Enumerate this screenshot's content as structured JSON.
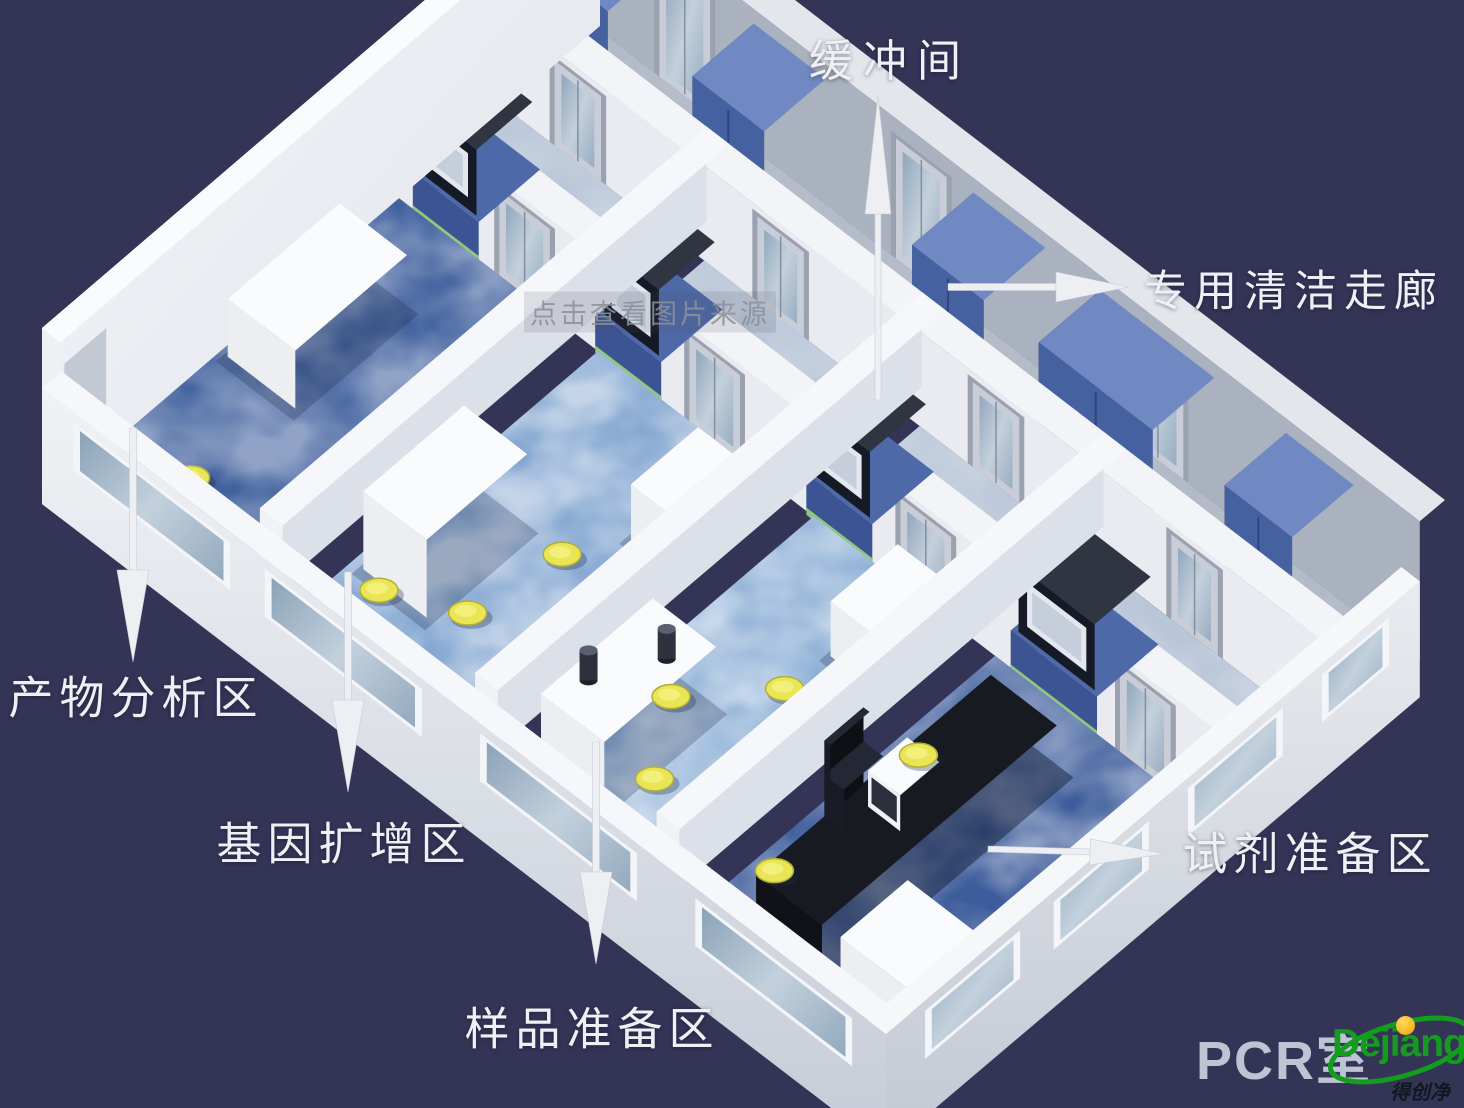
{
  "meta": {
    "width": 1464,
    "height": 1108,
    "background": "#343457",
    "title": "PCR实验室三维布局图"
  },
  "annotations": {
    "labels": [
      {
        "id": "buffer-room",
        "text": "缓冲间",
        "x": 890,
        "y": 60,
        "size": 44,
        "ls": 10
      },
      {
        "id": "clean-corridor",
        "text": "专用清洁走廊",
        "x": 1294,
        "y": 291,
        "size": 43,
        "ls": 7
      },
      {
        "id": "product-analysis-area",
        "text": "产物分析区",
        "x": 136,
        "y": 697,
        "size": 45,
        "ls": 6
      },
      {
        "id": "gene-amplification-area",
        "text": "基因扩增区",
        "x": 344,
        "y": 843,
        "size": 45,
        "ls": 6
      },
      {
        "id": "sample-preparation-area",
        "text": "样品准备区",
        "x": 592,
        "y": 1028,
        "size": 45,
        "ls": 6
      },
      {
        "id": "reagent-preparation-area",
        "text": "试剂准备区",
        "x": 1310,
        "y": 853,
        "size": 45,
        "ls": 6
      }
    ],
    "arrows": [
      {
        "id": "buffer-room",
        "x1": 878,
        "y1": 400,
        "x2": 878,
        "y2": 96,
        "shaft": 6,
        "headLen": 118,
        "headW": 26
      },
      {
        "id": "clean-corridor",
        "x1": 948,
        "y1": 287,
        "x2": 1128,
        "y2": 287,
        "shaft": 7,
        "headLen": 72,
        "headW": 30
      },
      {
        "id": "product-analysis",
        "x1": 133,
        "y1": 428,
        "x2": 133,
        "y2": 662,
        "shaft": 7,
        "headLen": 92,
        "headW": 32
      },
      {
        "id": "gene-amplification",
        "x1": 348,
        "y1": 572,
        "x2": 348,
        "y2": 792,
        "shaft": 7,
        "headLen": 92,
        "headW": 32
      },
      {
        "id": "sample-preparation",
        "x1": 596,
        "y1": 742,
        "x2": 596,
        "y2": 964,
        "shaft": 7,
        "headLen": 92,
        "headW": 32
      },
      {
        "id": "reagent-preparation",
        "x1": 988,
        "y1": 849,
        "x2": 1164,
        "y2": 854,
        "shaft": 6,
        "headLen": 74,
        "headW": 26
      }
    ],
    "watermark": {
      "text": "点击查看图片来源",
      "x": 650,
      "y": 312,
      "size": 27
    },
    "pcr_room": {
      "text": "PCR室",
      "x": 1196,
      "y": 1016,
      "size": 54
    },
    "logo": {
      "name": "Dejiang",
      "sub": "得创净化",
      "green": "#149c1e",
      "yellow": "#f0b400",
      "ink": "#12181f"
    }
  },
  "scene": {
    "corners": [
      [
        42,
        468
      ],
      [
        886,
        1114
      ],
      [
        1445,
        640
      ],
      [
        600,
        -10
      ]
    ],
    "colors": {
      "background": "#343457",
      "arrow": "#edeff3",
      "label": "#eef0f4",
      "wall_top": "#f5f6f9",
      "wall_front": "#eceef2",
      "wall_side": "#dce0e8",
      "cabinet_blue": "#46619f",
      "stool_yellow": "#e9e554",
      "glass": "#9db3c8",
      "floor_dark_blue": "#41619e",
      "floor_light_blue": "#7fa3cf",
      "corridor_floor": "#cdd5df",
      "buffer_floor": "#b9c6d8",
      "passbox_dark": "#151a26"
    },
    "rooms": [
      {
        "id": "product-analysis",
        "name": "产物分析区",
        "s": [
          0.022,
          0.235
        ],
        "floor": "#41619e",
        "mottle": 0.42
      },
      {
        "id": "gene-amplification",
        "name": "基因扩增区",
        "s": [
          0.262,
          0.49
        ],
        "floor": "#7fa3cf",
        "mottle": 0.55
      },
      {
        "id": "sample-preparation",
        "name": "样品准备区",
        "s": [
          0.517,
          0.705
        ],
        "floor": "#87abd4",
        "mottle": 0.55
      },
      {
        "id": "reagent-preparation",
        "name": "试剂准备区",
        "s": [
          0.732,
          0.978
        ],
        "floor": "#3d5c9b",
        "mottle": 0.42
      }
    ],
    "partitions": [
      [
        0.235,
        0.262
      ],
      [
        0.49,
        0.517
      ],
      [
        0.705,
        0.732
      ]
    ],
    "zones": {
      "roomT": [
        0.035,
        0.6
      ],
      "backWallT": [
        0.6,
        0.645
      ],
      "bufferT": [
        0.645,
        0.79
      ],
      "corridorWallT": [
        0.79,
        0.835
      ],
      "corridorT": [
        0.835,
        0.955
      ],
      "outerWallT": [
        0.955,
        1.0
      ]
    },
    "corridor_cabinets": [
      [
        0.03,
        0.115
      ],
      [
        0.215,
        0.3
      ],
      [
        0.475,
        0.56
      ],
      [
        0.625,
        0.76
      ],
      [
        0.845,
        0.925
      ]
    ],
    "passboxes": [
      [
        0.052,
        0.118
      ],
      [
        0.268,
        0.334
      ],
      [
        0.518,
        0.584
      ],
      [
        0.76,
        0.85
      ]
    ],
    "back_doors": [
      0.145,
      0.37,
      0.62,
      0.88
    ],
    "buffer_doors": [
      0.085,
      0.325,
      0.58,
      0.815
    ],
    "ne_doors": [
      0.1,
      0.38,
      0.66
    ],
    "front_windows": [
      [
        0.045,
        0.215
      ],
      [
        0.272,
        0.442
      ],
      [
        0.527,
        0.697
      ],
      [
        0.782,
        0.952
      ]
    ],
    "se_windows": [
      [
        0.07,
        0.24
      ],
      [
        0.3,
        0.47
      ],
      [
        0.54,
        0.71
      ],
      [
        0.78,
        0.9
      ]
    ],
    "stools": {
      "room1": [
        [
          0.1,
          0.115
        ],
        [
          0.15,
          0.06
        ]
      ],
      "room2": [
        [
          0.3,
          0.15
        ],
        [
          0.372,
          0.2
        ],
        [
          0.388,
          0.345
        ]
      ],
      "room3": [
        [
          0.56,
          0.28
        ],
        [
          0.61,
          0.175
        ],
        [
          0.65,
          0.1
        ],
        [
          0.625,
          0.385
        ]
      ],
      "room4": [
        [
          0.752,
          0.175
        ],
        [
          0.757,
          0.425
        ]
      ]
    },
    "furniture": {
      "white_bench_room1": {
        "s": [
          0.035,
          0.115
        ],
        "t": [
          0.28,
          0.48
        ],
        "h": 58
      },
      "fridge_room2": {
        "s": [
          0.275,
          0.35
        ],
        "t": [
          0.16,
          0.34
        ],
        "h": 78
      },
      "ac_box_room2": {
        "s": [
          0.42,
          0.475
        ],
        "t": [
          0.42,
          0.54
        ],
        "h": 55
      },
      "machine_room3": {
        "s": [
          0.525,
          0.6
        ],
        "t": [
          0.1,
          0.3
        ],
        "h": 66,
        "ports": [
          [
            0.545,
            0.155
          ],
          [
            0.578,
            0.245
          ]
        ]
      },
      "ac_box_room3": {
        "s": [
          0.63,
          0.69
        ],
        "t": [
          0.46,
          0.58
        ],
        "h": 55
      },
      "black_bench_room4": {
        "s": [
          0.78,
          0.858
        ],
        "t": [
          0.1,
          0.52
        ],
        "h": 50
      },
      "monitor_room4": {
        "s": [
          0.8,
          0.838
        ],
        "t": [
          0.27,
          0.34
        ]
      },
      "chair_room4": {
        "s": [
          0.745,
          0.768
        ],
        "t": [
          0.275,
          0.345
        ]
      },
      "white_cabinet_room4": {
        "s": [
          0.88,
          0.962
        ],
        "t": [
          0.1,
          0.22
        ],
        "h": 52
      }
    }
  }
}
